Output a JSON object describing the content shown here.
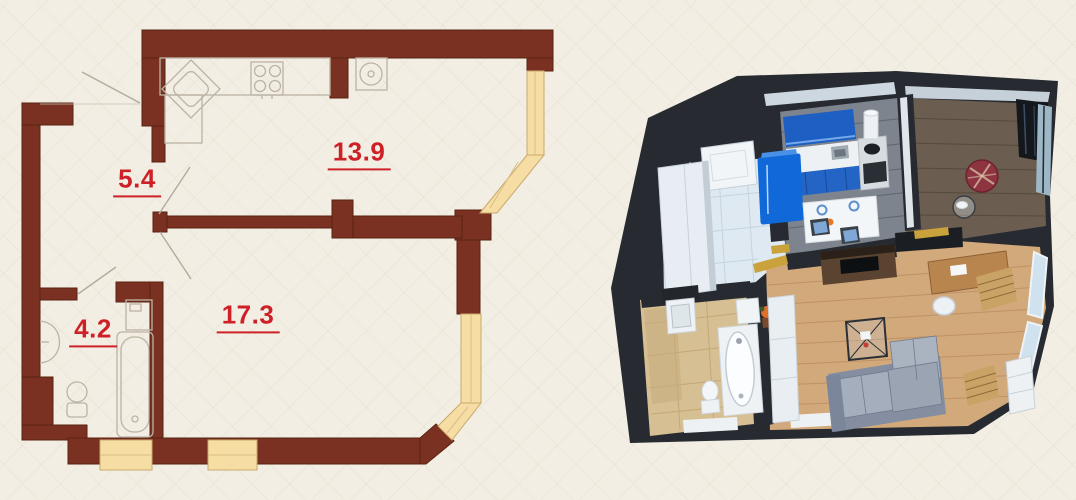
{
  "meta": {
    "description": "Apartment floor plan: 2D scheme with room areas (left) and 3D top-down render (right)",
    "width_px": 1076,
    "height_px": 500
  },
  "plan2d": {
    "rooms": [
      {
        "name": "hallway",
        "area": "5.4"
      },
      {
        "name": "kitchen",
        "area": "13.9"
      },
      {
        "name": "bathroom",
        "area": "4.2"
      },
      {
        "name": "living-room",
        "area": "17.3"
      }
    ],
    "fixtures": [
      "corner-sink",
      "stove-4-burner",
      "round-appliance",
      "wash-basin",
      "toilet",
      "washing-machine",
      "bathtub"
    ],
    "colors": {
      "wall": "#7a3122",
      "wall_edge": "#5b2312",
      "window": "#f6dda4",
      "window_frame": "#c9a96a",
      "fixture_outline": "#bcb3a5",
      "door_swing": "#b3ab9d",
      "label": "#ce2127",
      "background": "#f2eee3"
    }
  },
  "render3d": {
    "rooms": [
      "hallway",
      "kitchen",
      "bay-room",
      "living-room",
      "bathroom"
    ],
    "furniture": [
      "entrance-door",
      "wardrobe",
      "fridge",
      "kitchen-cabinets",
      "counter",
      "stove-oven",
      "cooker-hood",
      "dining-table",
      "chairs",
      "plaid-pouf",
      "glass-side-table",
      "tv-sideboard",
      "plant",
      "sofa",
      "coffee-table",
      "desk",
      "desk-chair",
      "bookcase",
      "wood-blinds",
      "vanity",
      "toilet",
      "bathtub",
      "storage-column"
    ],
    "colors": {
      "walls": "#272b31",
      "hall_tile": "#dfe9f1",
      "kitchen_floor": "#7e848d",
      "bay_floor": "#6b5e50",
      "living_floor": "#d2a97b",
      "bath_floor": "#d6bf92",
      "cabinets_blue": "#1d5fc2",
      "fridge_blue": "#1168d8",
      "sofa_gray": "#9aa3b0",
      "pouf_red": "#8e3340",
      "threshold_gold": "#c9a23c"
    }
  }
}
